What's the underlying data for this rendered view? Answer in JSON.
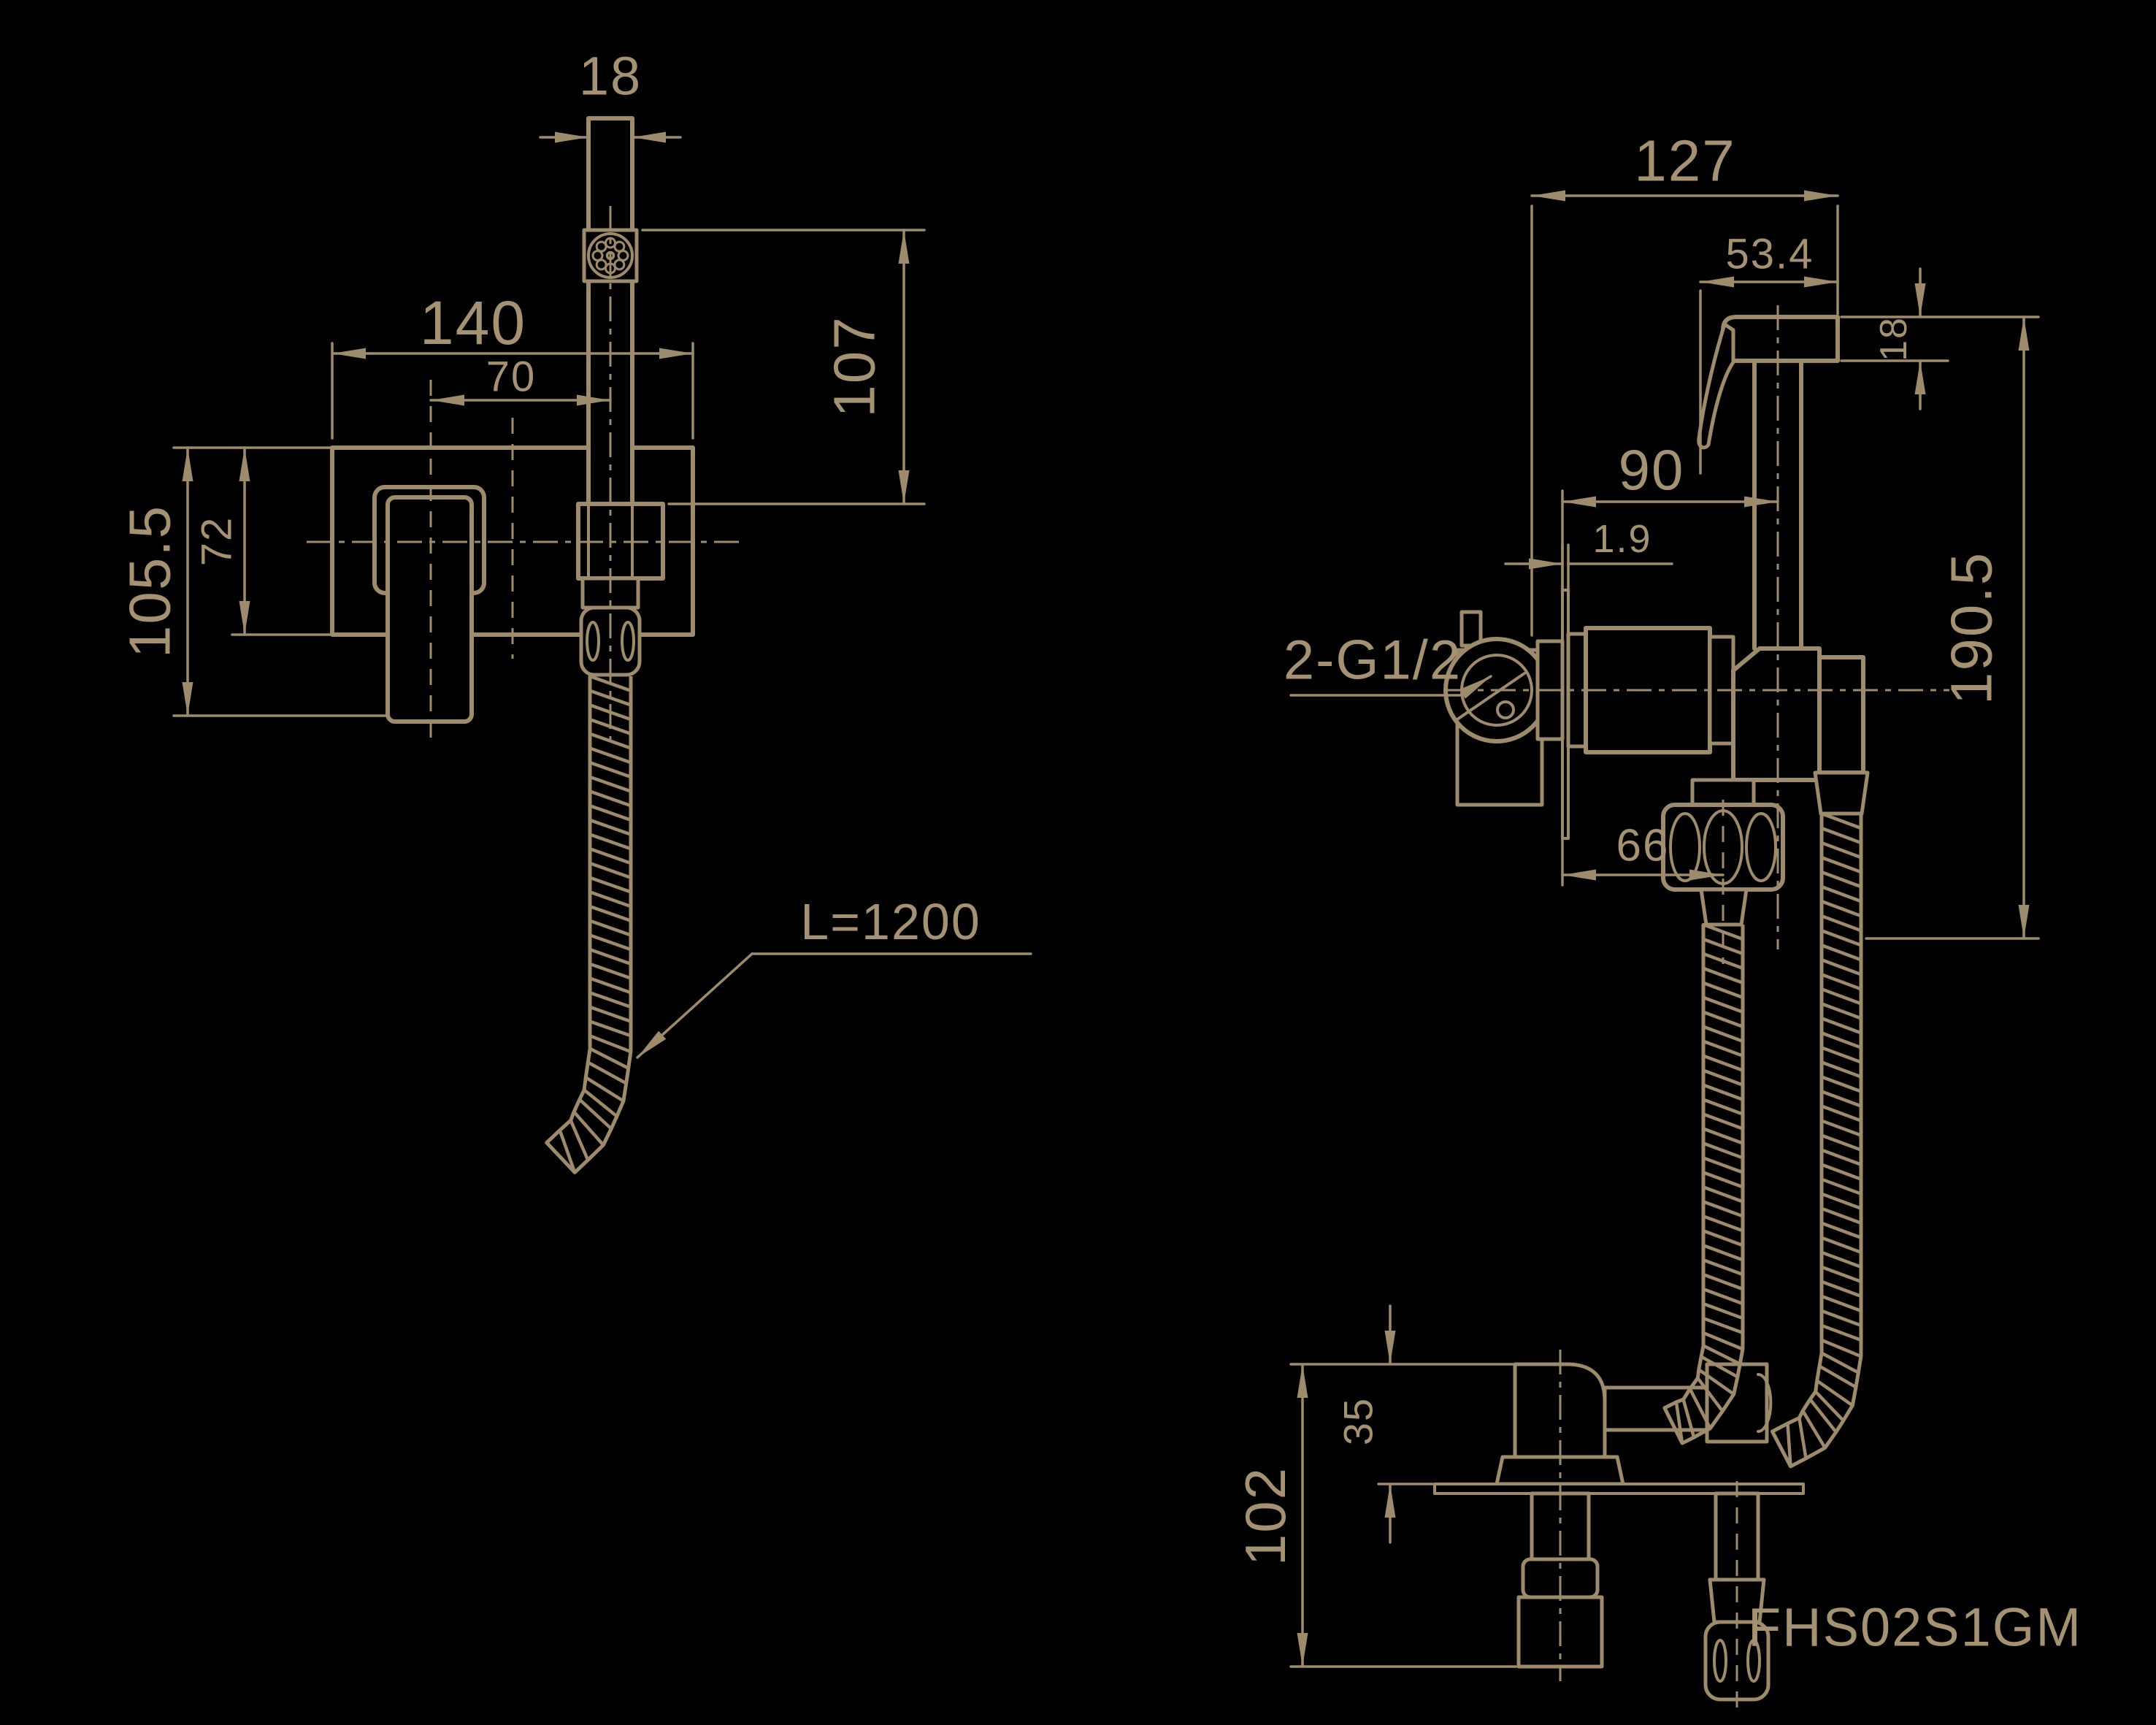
{
  "drawing": {
    "model": "FHS02S1GM",
    "colors": {
      "background": "#000000",
      "line": "#9d8b6c",
      "text": "#a59272"
    },
    "views": {
      "front": {
        "dims": {
          "head_width": "18",
          "plate_width": "140",
          "handle_offset": "70",
          "head_height": "107",
          "plate_height": "105.5",
          "inner_height": "72"
        },
        "hose_label": "L=1200"
      },
      "side": {
        "dims": {
          "total_depth": "127",
          "head_depth": "53.4",
          "head_thickness": "18",
          "body_depth": "90",
          "flange_thickness": "1.9",
          "total_height": "190.5",
          "hose_offset": "66"
        },
        "port_label": "2-G1/2"
      },
      "bottom": {
        "dims": {
          "total_height": "102",
          "spout_height": "35"
        }
      }
    }
  }
}
